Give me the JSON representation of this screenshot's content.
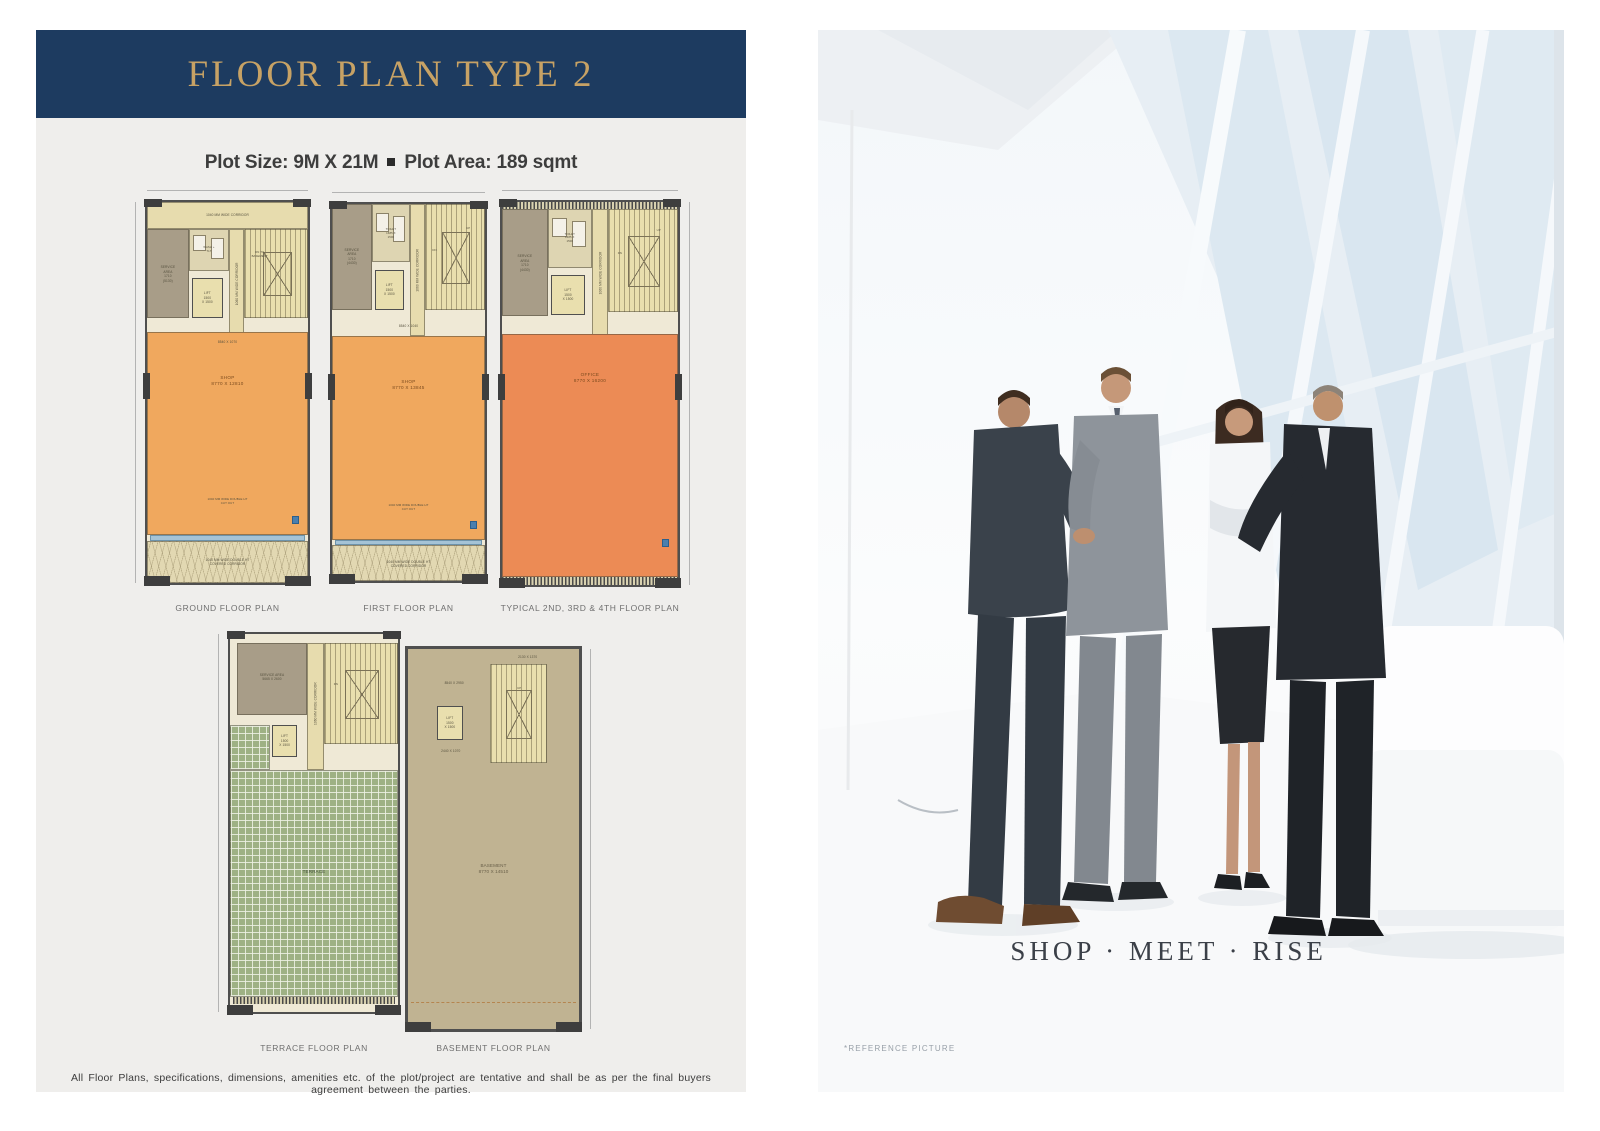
{
  "header": {
    "title": "FLOOR PLAN TYPE 2",
    "plot_size": "Plot Size: 9M X 21M",
    "separator": "■",
    "plot_area": "Plot Area: 189 sqmt"
  },
  "plans": {
    "ground": {
      "name": "GROUND FLOOR PLAN",
      "top_corridor": "1040 MM WIDE CORRIDOR",
      "service_area": "SERVICE\nAREA\n1710\n(5130)",
      "wash": "WASH +\nTLT",
      "lift": "LIFT\n1500\nX 1500",
      "corridor": "1060 MM WIDE CORRIDOR",
      "stair_note": "DN TO\nBASEMENT",
      "entry_dim": "8540 X 1070",
      "room": "SHOP\n8770 X 12810",
      "cutout": "1040 MM WIDE DOUBLE HT\nCUT OUT",
      "bottom_corridor": "1040 MM WIDE DOUBLE HT\nCOVERED CORRIDOR"
    },
    "first": {
      "name": "FIRST FLOOR PLAN",
      "service_area": "SERVICE\nAREA\n1710\n(4430)",
      "toilet": "TOILET\n1685 X\n1500",
      "lift": "LIFT\n1500\nX 1500",
      "corridor": "1060 MM WIDE CORRIDOR",
      "stair_up": "UP",
      "stair_dn": "DN",
      "entry_dim": "8540 X 1040",
      "room": "SHOP\n8770 X 13845",
      "cutout": "1040 MM WIDE DOUBLE HT\nCUT OUT",
      "bottom_corridor": "1040 MM WIDE DOUBLE HT\nCOVERED CORRIDOR"
    },
    "typical": {
      "name": "TYPICAL 2ND, 3RD & 4TH FLOOR PLAN",
      "service_area": "SERVICE\nAREA\n1710\n(4430)",
      "toilet": "TOILET\n1685 X\n1500",
      "lift": "LIFT\n1500\nX 1500",
      "corridor": "1060 MM WIDE CORRIDOR",
      "stair_up": "UP",
      "stair_dn": "DN",
      "room": "OFFICE\n8770 X 16200"
    },
    "terrace": {
      "name": "TERRACE FLOOR PLAN",
      "service_area": "SERVICE AREA\n5665 X 2600",
      "lift": "LIFT\n1500\nX 1500",
      "corridor": "1060 MM WIDE CORRIDOR",
      "stair_dn": "DN",
      "room": "TERRACE"
    },
    "basement": {
      "name": "BASEMENT FLOOR PLAN",
      "dim_top": "8540 X 2950",
      "dim_right": "2130 X 1370",
      "lift": "LIFT\n1500\nX 1500",
      "lift_dim": "2440 X 1070",
      "stair_up": "UP",
      "room": "BASEMENT\n8770 X 14510"
    }
  },
  "disclaimer": "All Floor Plans, specifications, dimensions, amenities etc. of the plot/project are tentative and shall be as per the final buyers agreement between the parties.",
  "photo": {
    "caption": "SHOP · MEET · RISE",
    "reference_note": "*REFERENCE PICTURE"
  },
  "colors": {
    "banner_navy": "#1d3b60",
    "title_gold": "#c7a265",
    "shop_orange": "#f0a85e",
    "office_orange": "#ec8b55",
    "terrace_green": "#9eb184",
    "basement_tan": "#c0b392",
    "glass_blue": "#a5c3d6"
  }
}
